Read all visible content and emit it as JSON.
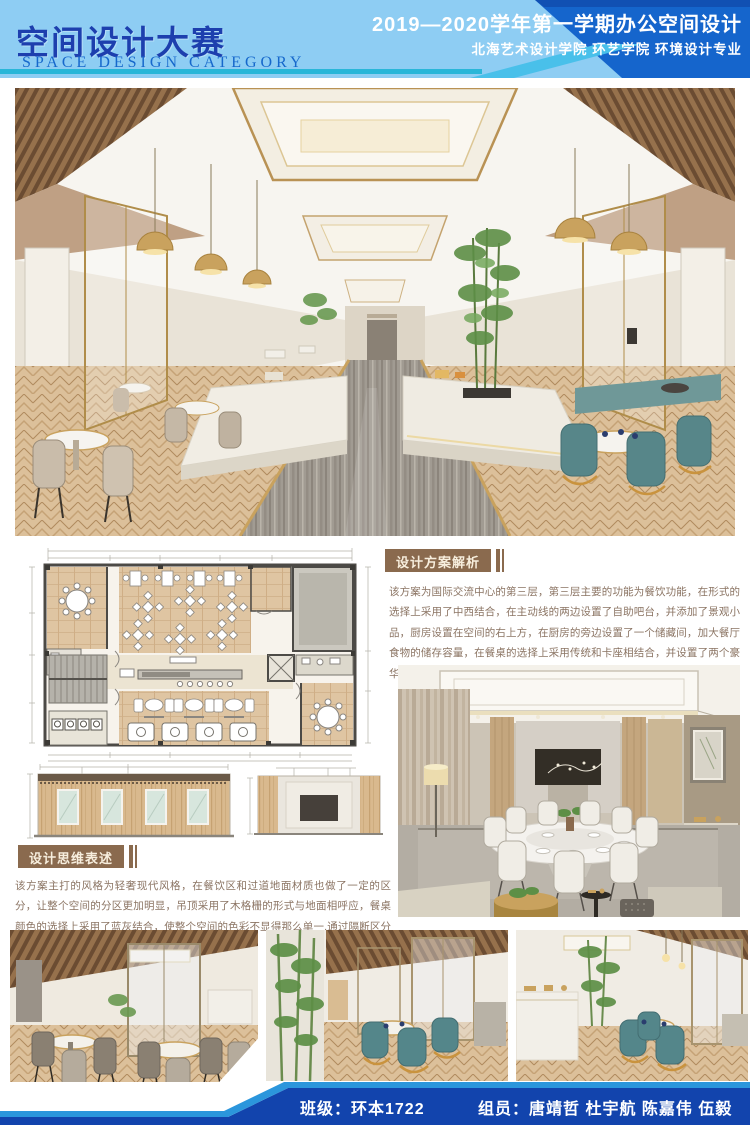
{
  "header": {
    "title": "空间设计大赛",
    "subtitle": "SPACE DESIGN CATEGORY",
    "term": "2019—2020学年第一学期办公空间设计",
    "school": "北海艺术设计学院 环艺学院 环境设计专业"
  },
  "sections": {
    "analysis": {
      "label": "设计方案解析",
      "body": "该方案为国际交流中心的第三层，第三层主要的功能为餐饮功能，在形式的选择上采用了中西结合，在主动线的两边设置了自助吧台，并添加了景观小品，厨房设置在空间的右上方，在厨房的旁边设置了一个储藏间，加大餐厅食物的储存容量，在餐桌的选择上采用传统和卡座相结合，并设置了两个豪华包间,专门为高端的客户群体量身定做。"
    },
    "thinking": {
      "label": "设计思维表述",
      "body": "该方案主打的风格为轻奢现代风格，在餐饮区和过道地面材质也做了一定的区分，让整个空间的分区更加明显，吊顶采用了木格栅的形式与地面相呼应，餐桌颜色的选择上采用了蓝灰结合，使整个空间的色彩不显得那么单一,通过隔断区分了传统餐区和卡座区域。"
    }
  },
  "images": {
    "main_render": "restaurant-hall-perspective-render",
    "floor_plan": "third-floor-restaurant-plan-drawing",
    "elevation_left": "wood-wall-elevation-drawing",
    "elevation_right": "tv-wall-elevation-drawing",
    "vip_render": "vip-dining-room-render",
    "photo_1": "dining-area-beige-chairs-render",
    "photo_2": "booth-area-teal-chairs-render",
    "photo_3": "buffet-counter-teal-chairs-render"
  },
  "footer": {
    "class_label": "班级：环本1722",
    "team_label": "组员：唐靖哲  杜宇航  陈嘉伟  伍毅"
  },
  "colors": {
    "header_light": "#8ecdf3",
    "header_blue": "#1565cc",
    "header_stripe": "#49c0ea",
    "header_teal_line": "#29b6d8",
    "title_blue": "#1d3fae",
    "subtitle_blue": "#1668cc",
    "label_brown": "#8a6a4e",
    "label_text": "#f7eedd",
    "body_text": "#8b7463",
    "footer_blue": "#1244ad",
    "footer_stripe": "#2b96dc",
    "wood": "#d9bc92",
    "teal_chair": "#578689",
    "gold": "#c9a25e"
  }
}
